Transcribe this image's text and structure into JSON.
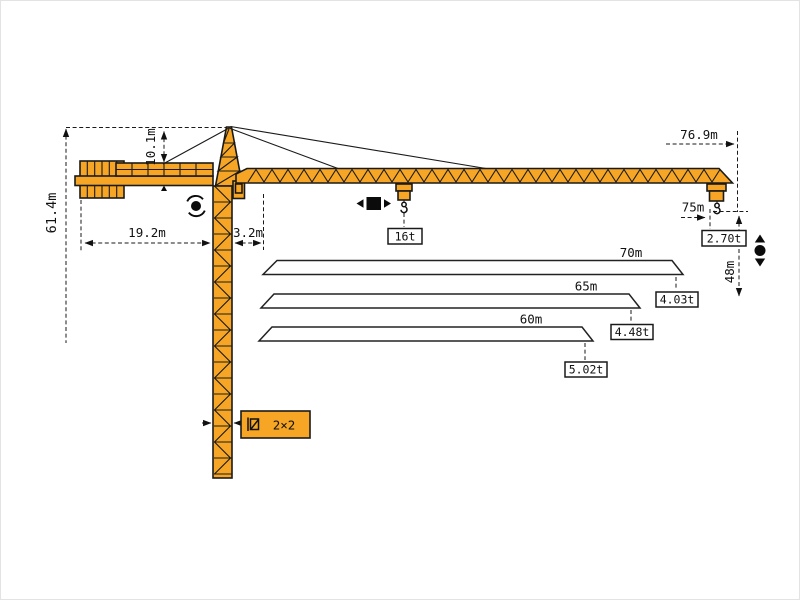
{
  "colors": {
    "crane": "#F6A624",
    "outline": "#1A1A1A",
    "background": "#FFFFFF",
    "frame": "#E3E3E3"
  },
  "dimensions": {
    "total_height": "61.4m",
    "tower_head_height": "10.1m",
    "counter_jib_length": "19.2m",
    "rear_slew_offset": "3.2m",
    "jib_overall_length": "76.9m",
    "max_working_radius": "75m",
    "hook_travel_height": "48m",
    "mast_section": "2×2"
  },
  "loads": {
    "max_load": "16t",
    "tip_load_at_75m": "2.70t"
  },
  "jib_variants": [
    {
      "length": "70m",
      "tip_load": "4.03t"
    },
    {
      "length": "65m",
      "tip_load": "4.48t"
    },
    {
      "length": "60m",
      "tip_load": "5.02t"
    }
  ],
  "icons": {
    "slewing-icon": "black-dot-with-rotation-arcs",
    "trolley-travel-icon": "black-square-with-left-right-triangles",
    "hoist-icon": "black-dot-with-up-down-triangles",
    "mast-section-icon": "small-square-with-diagonal"
  }
}
